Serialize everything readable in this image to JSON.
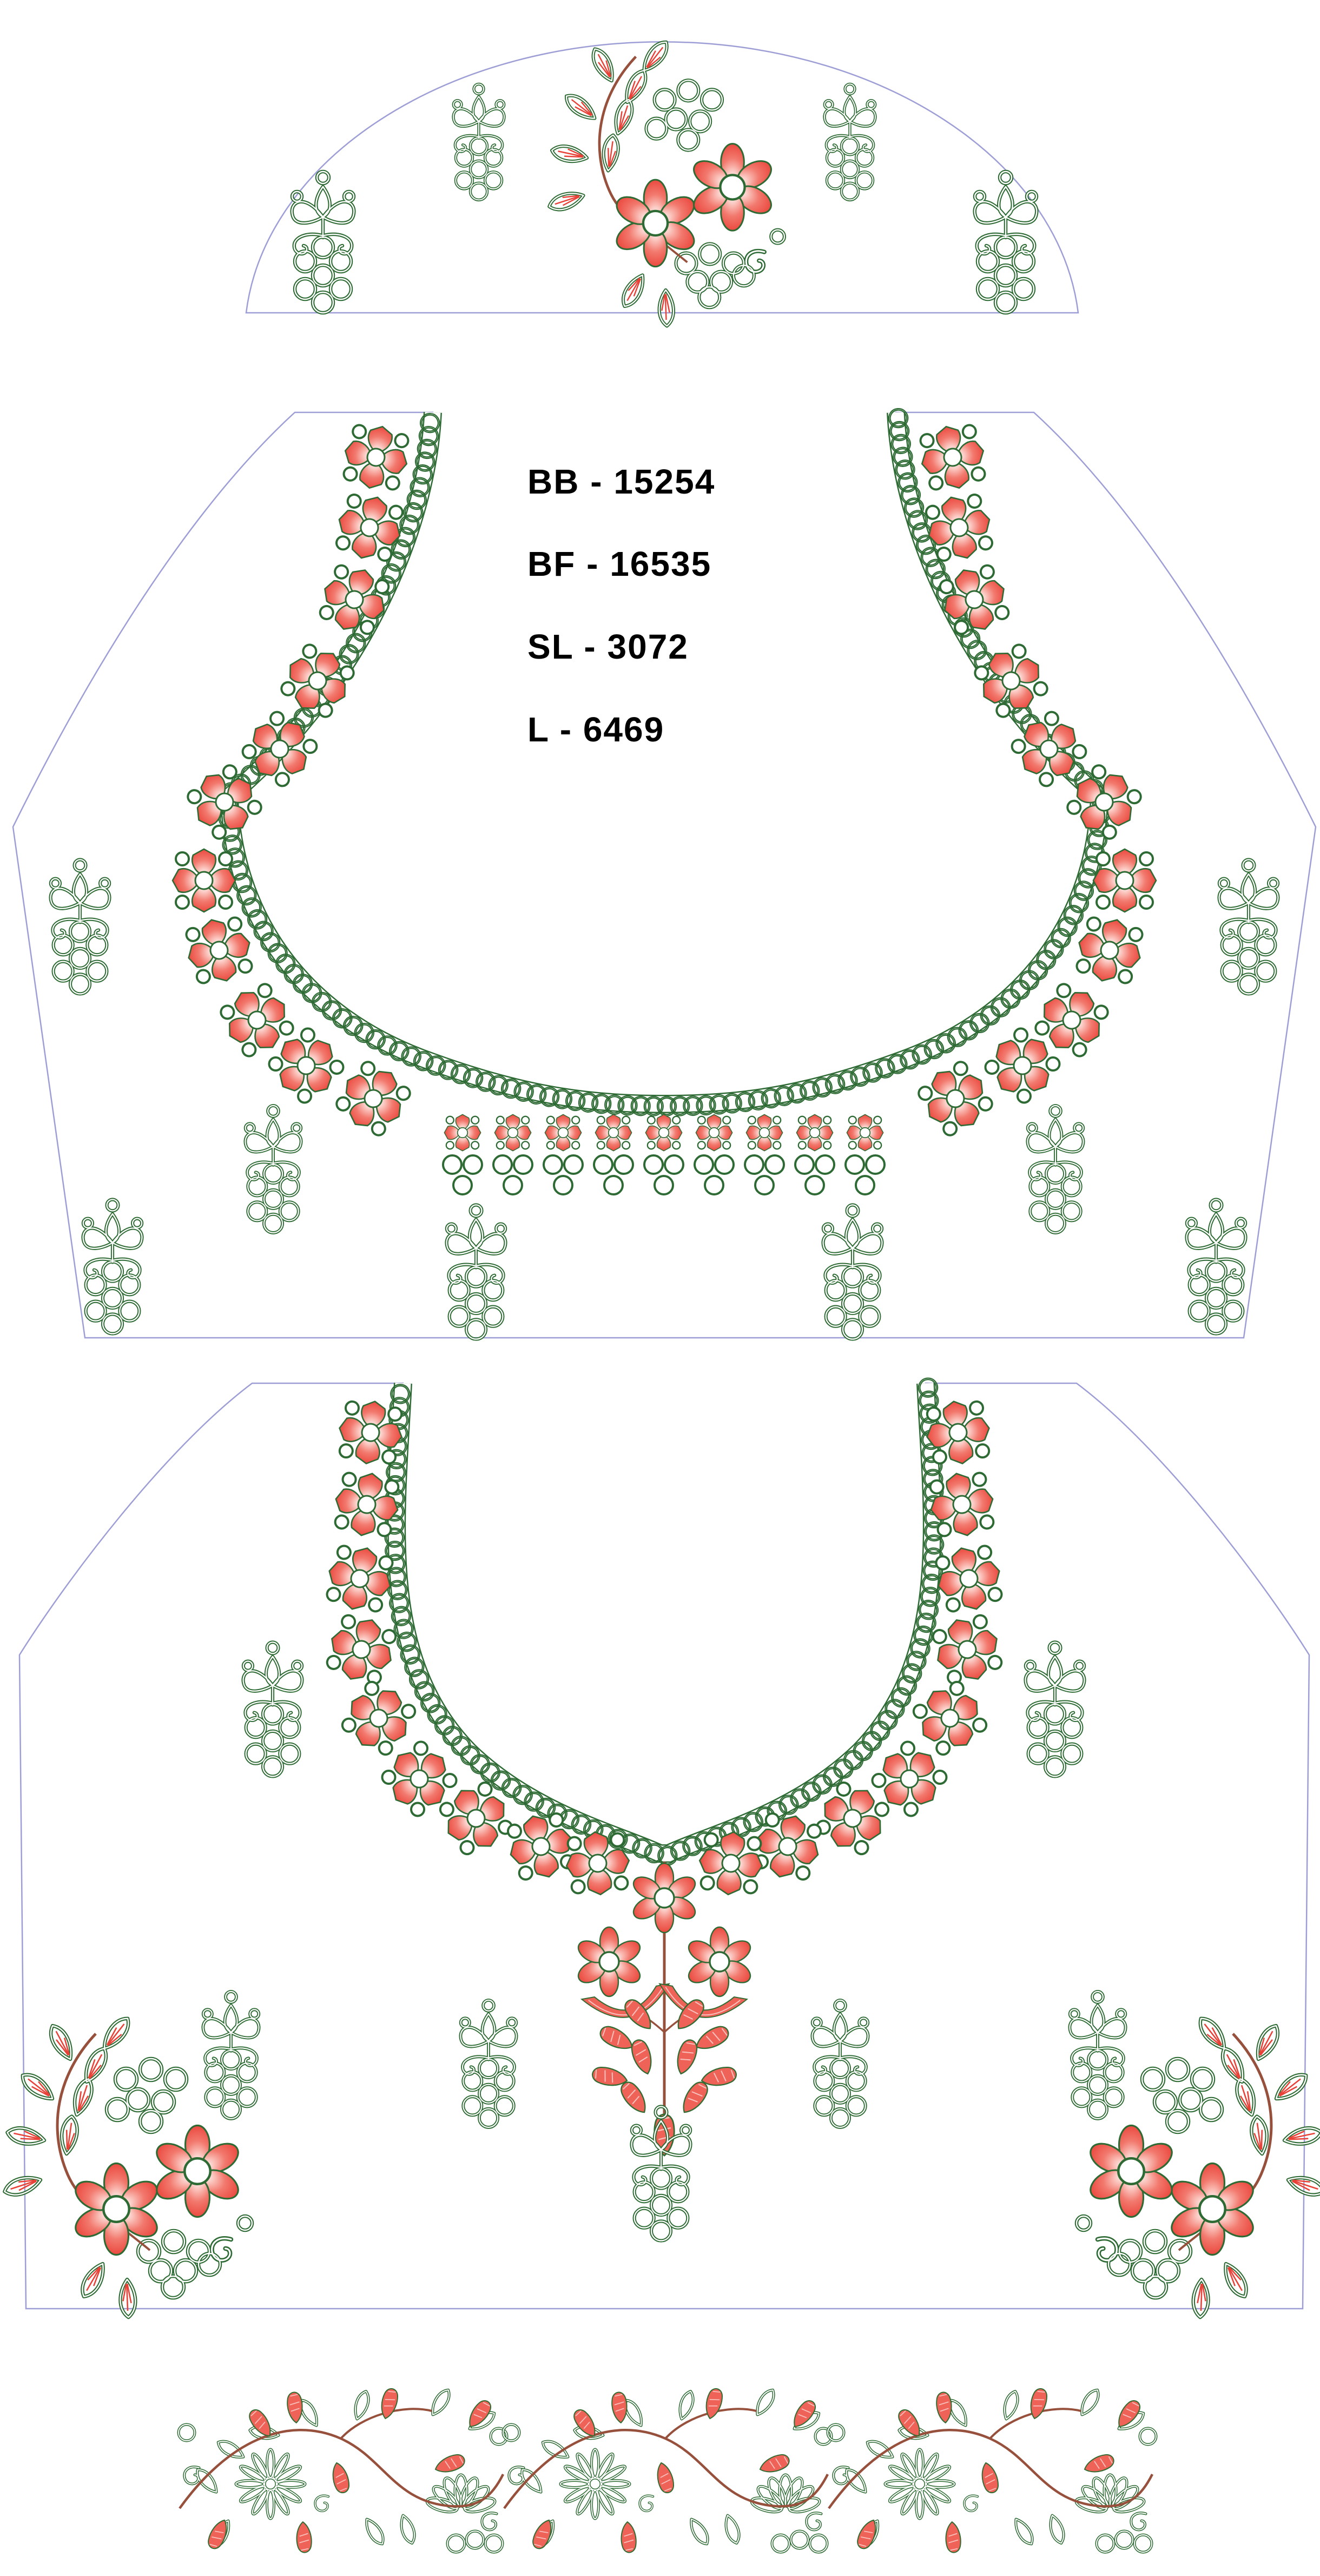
{
  "design_labels": {
    "bb": "BB - 15254",
    "bf": "BF - 16535",
    "sl": "SL - 3072",
    "l": "L - 6469"
  },
  "palette": {
    "thread_red": "#ee5449",
    "thread_green": "#2e6b34",
    "outline_lavender": "#9e9ed6",
    "stem_brown": "#96503c",
    "label_text": "#000000",
    "background": "#ffffff"
  }
}
